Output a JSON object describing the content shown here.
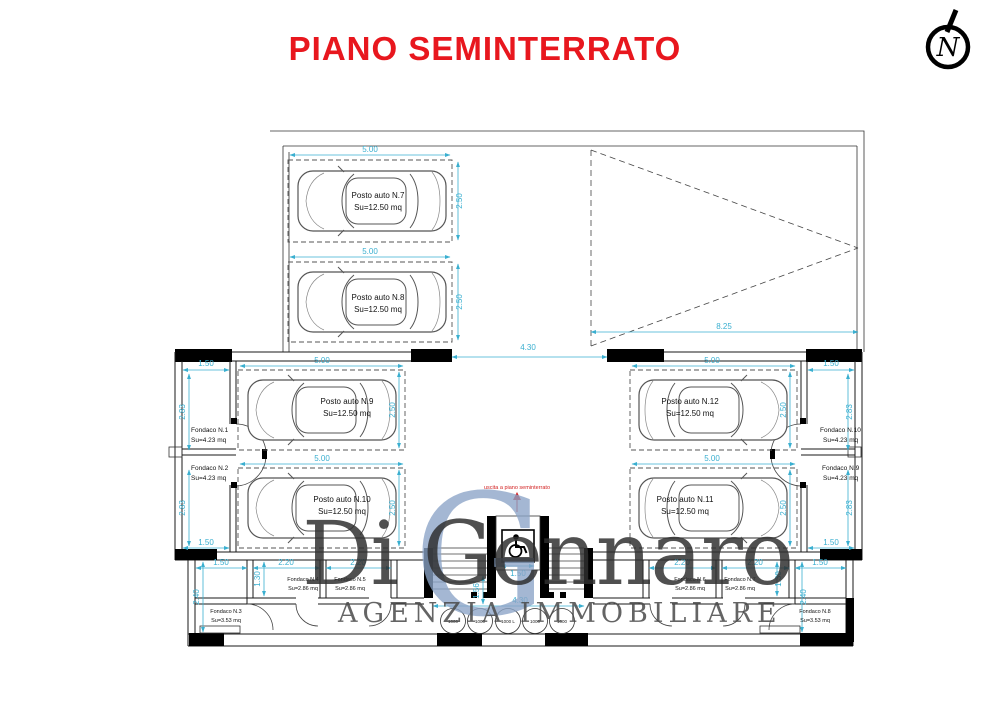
{
  "title": "PIANO SEMINTERRATO",
  "north_label": "N",
  "exit_label": "uscita a piano seminterrato",
  "watermark": {
    "initial": "G",
    "name": "Di Gennaro",
    "subtitle": "AGENZIA IMMOBILIARE"
  },
  "parking_spots": [
    {
      "name": "Posto auto N.7",
      "area": "Su=12.50 mq"
    },
    {
      "name": "Posto auto N.8",
      "area": "Su=12.50 mq"
    },
    {
      "name": "Posto auto N.9",
      "area": "Su=12.50 mq"
    },
    {
      "name": "Posto auto N.10",
      "area": "Su=12.50 mq"
    },
    {
      "name": "Posto auto N.11",
      "area": "Su=12.50 mq"
    },
    {
      "name": "Posto auto N.12",
      "area": "Su=12.50 mq"
    }
  ],
  "storage_rooms": [
    {
      "name": "Fondaco N.1",
      "area": "Su=4.23 mq"
    },
    {
      "name": "Fondaco N.2",
      "area": "Su=4.23 mq"
    },
    {
      "name": "Fondaco N.3",
      "area": "Su=3.53 mq"
    },
    {
      "name": "Fondaco N.4",
      "area": "Su=2.86 mq"
    },
    {
      "name": "Fondaco N.5",
      "area": "Su=2.86 mq"
    },
    {
      "name": "Fondaco N.6",
      "area": "Su=2.86 mq"
    },
    {
      "name": "Fondaco N.7",
      "area": "Su=2.86 mq"
    },
    {
      "name": "Fondaco N.8",
      "area": "Su=3.53 mq"
    },
    {
      "name": "Fondaco N.9",
      "area": "Su=4.23 mq"
    },
    {
      "name": "Fondaco N.10",
      "area": "Su=4.23 mq"
    }
  ],
  "dimensions": {
    "stall_width": "5.00",
    "stall_depth": "2.50",
    "corridor_width": "1.50",
    "corridor_depth": "2.83",
    "ramp_length": "8.25",
    "aisle_opening": "4.30",
    "room_width": "2.20",
    "room_depth": "1.30",
    "outer_depth": "2.40",
    "stair_depth": "1.56",
    "lift_width": "1.50"
  },
  "tanks": [
    "1000",
    "1000",
    "1000 L",
    "1000",
    "1000"
  ],
  "colors": {
    "dimension": "#3aafd0",
    "title": "#e8171e",
    "watermark_initial": "#8ba4c7",
    "watermark_text": "#2f2f2f",
    "watermark_subtitle": "#4a4a4a"
  }
}
